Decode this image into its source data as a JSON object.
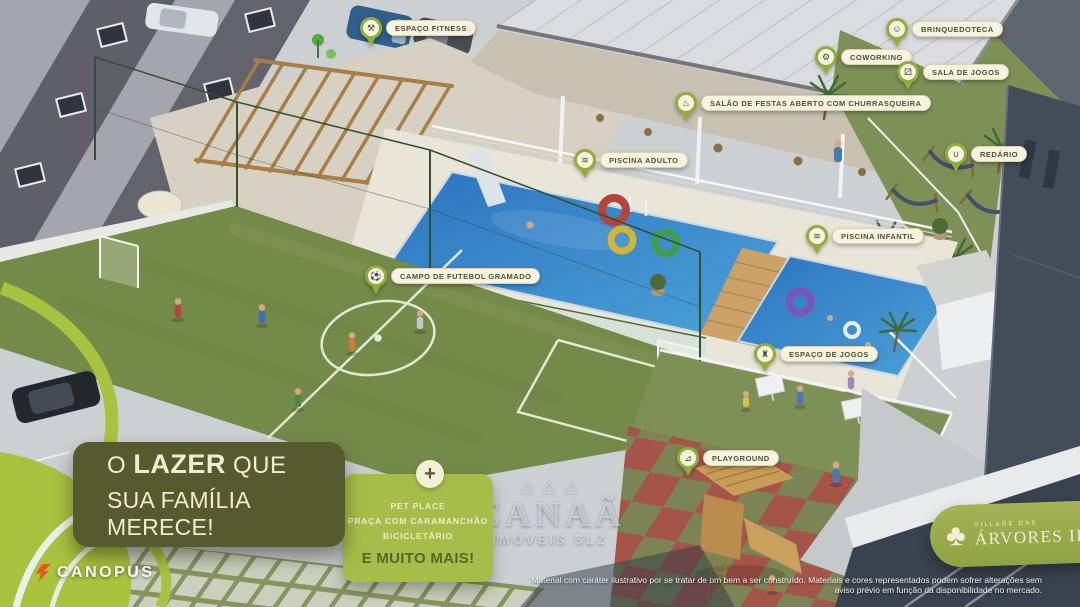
{
  "project": {
    "headline": {
      "word1": "O",
      "highlight": "LAZER",
      "word2": "QUE",
      "line2": "SUA FAMÍLIA MERECE!"
    },
    "extras": {
      "plus_icon": "plus-icon",
      "items": [
        "PET PLACE",
        "PRAÇA COM CARAMANCHÃO",
        "BICICLETÁRIO"
      ],
      "emphasis": "E MUITO MAIS!"
    },
    "developer_logo": "CANOPUS",
    "project_logo": {
      "prefix": "VILLAGE DAS",
      "name": "ÁRVORES III",
      "icon": "tree-icon"
    },
    "watermark": {
      "icon": "houses-icon",
      "brand": "CANAÃ",
      "subtitle": "IMÓVEIS SLZ"
    },
    "disclaimer": {
      "line1": "Material com caráter ilustrativo por se tratar de um bem a ser construído. Materiais e cores representados podem sofrer alterações sem",
      "line2": "aviso prévio em função da disponibilidade no mercado."
    }
  },
  "callouts": [
    {
      "label": "ESPAÇO FITNESS",
      "icon": "dumbbell-icon"
    },
    {
      "label": "BRINQUEDOTECA",
      "icon": "teddy-bear-icon"
    },
    {
      "label": "COWORKING",
      "icon": "workstation-icon"
    },
    {
      "label": "SALA DE JOGOS",
      "icon": "gamepad-icon"
    },
    {
      "label": "SALÃO DE FESTAS ABERTO COM CHURRASQUEIRA",
      "icon": "barbecue-icon"
    },
    {
      "label": "PISCINA ADULTO",
      "icon": "swimmer-icon"
    },
    {
      "label": "REDÁRIO",
      "icon": "hammock-icon"
    },
    {
      "label": "PISCINA INFANTIL",
      "icon": "swimmer-icon"
    },
    {
      "label": "CAMPO DE FUTEBOL GRAMADO",
      "icon": "soccer-ball-icon"
    },
    {
      "label": "ESPAÇO DE JOGOS",
      "icon": "board-game-icon"
    },
    {
      "label": "PLAYGROUND",
      "icon": "slide-icon"
    }
  ],
  "colors": {
    "brand_lime": "#a9c23f",
    "pin_green": "#8fae3b",
    "label_cream": "#f7f3de",
    "dark_olive": "#565a2f",
    "extras_green": "#a6bd49",
    "pool_blue": "#2d74c0",
    "grass_green": "#7d9156",
    "canopus_orange": "#e8581d"
  }
}
